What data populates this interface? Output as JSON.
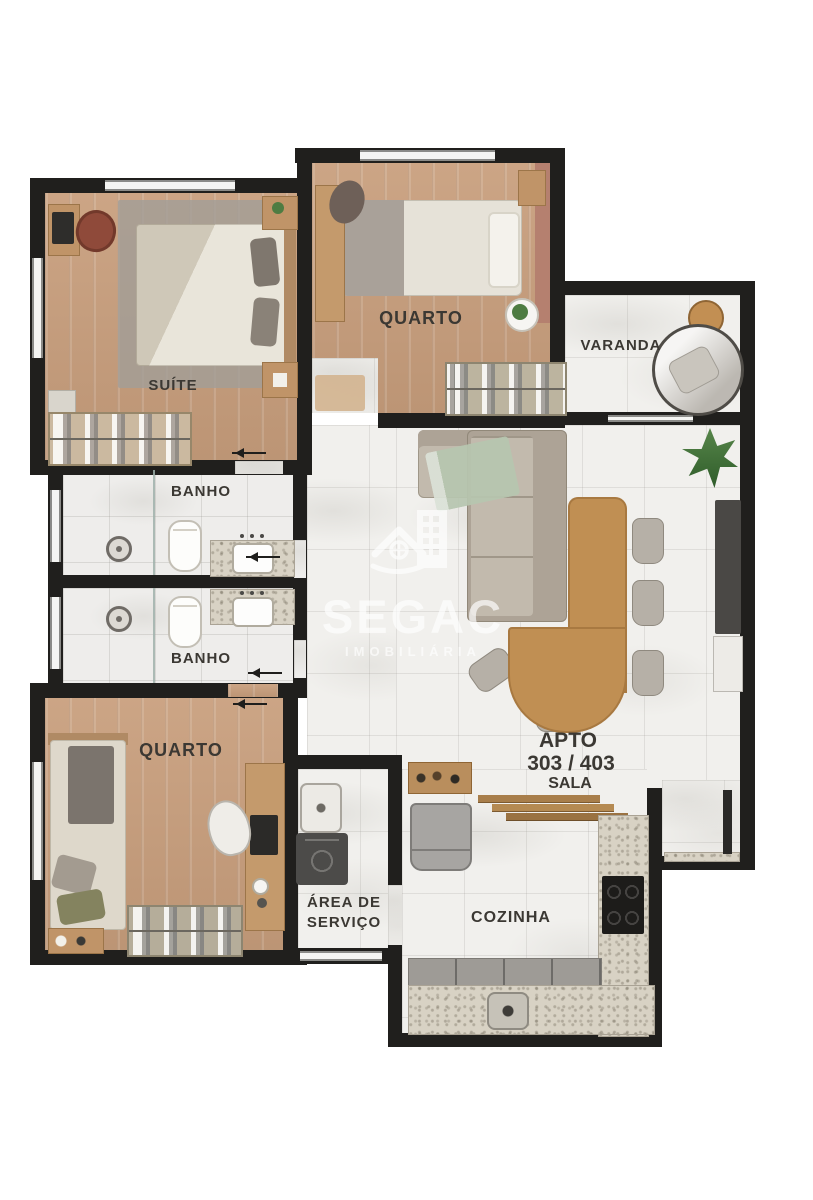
{
  "watermark": {
    "brand": "SEGAC",
    "subtitle": "IMOBILIÁRIA",
    "icon": "house-building-logo"
  },
  "unit_label": {
    "line1": "APTO",
    "line2": "303 / 403",
    "line3": "SALA"
  },
  "rooms": {
    "suite": "SUÍTE",
    "quarto_top": "QUARTO",
    "varanda": "VARANDA",
    "banho_upper": "BANHO",
    "banho_lower": "BANHO",
    "quarto_bottom": "QUARTO",
    "area_servico": "ÁREA DE SERVIÇO",
    "cozinha": "COZINHA"
  },
  "colors": {
    "wall": "#201f1d",
    "wood_floor": "#c89e7c",
    "marble_floor": "#f1f0ed",
    "granite_counter": "#d8d2c4",
    "label_text": "#3b3833",
    "furniture_wood": "#c08f53",
    "accent_wall": "#b5806f",
    "plant_green": "#4e7c42",
    "watermark_white": "#ffffff"
  }
}
